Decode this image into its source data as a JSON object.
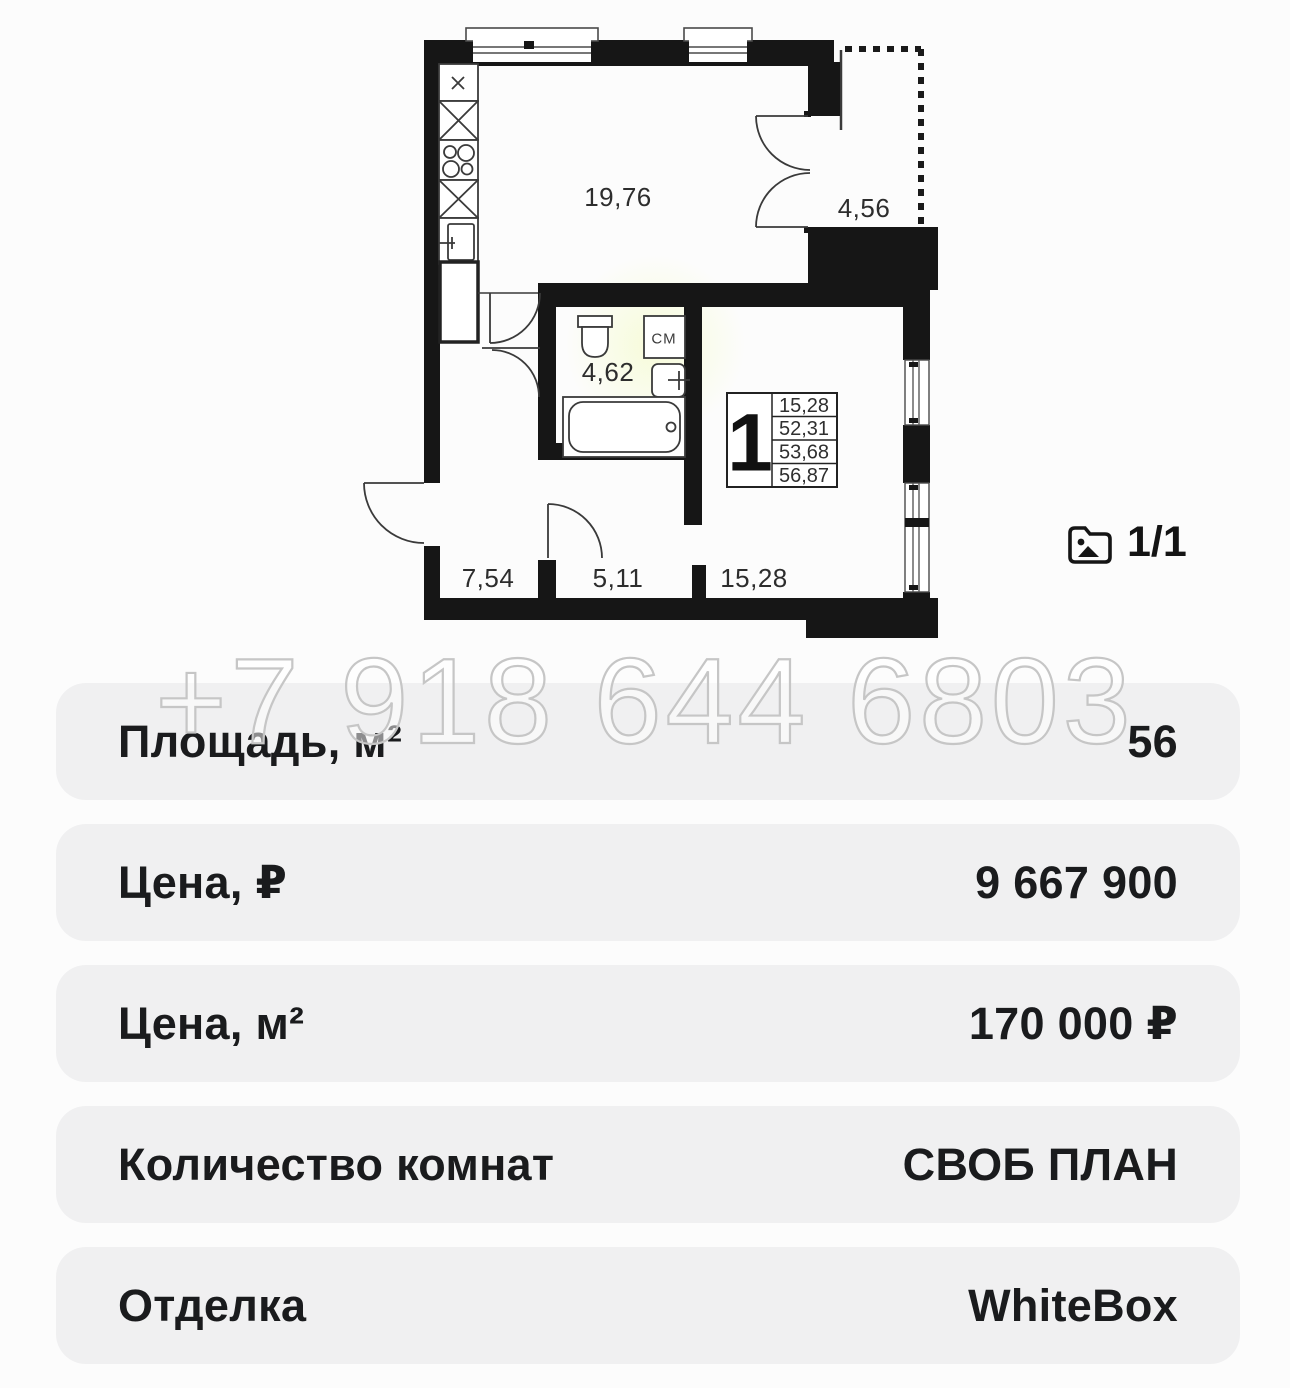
{
  "floor_plan": {
    "room_labels": {
      "kitchen_living": "19,76",
      "balcony": "4,56",
      "bathroom": "4,62",
      "hallway": "7,54",
      "corridor": "5,11",
      "room": "15,28"
    },
    "legend": {
      "rooms_count": "1",
      "areas": [
        "15,28",
        "52,31",
        "53,68",
        "56,87"
      ]
    },
    "washing_machine_label": "СМ"
  },
  "photo_counter": {
    "text": "1/1"
  },
  "watermark": {
    "text": "+7 918 644 6803"
  },
  "details": {
    "rows": [
      {
        "label": "Площадь, м²",
        "value": "56"
      },
      {
        "label": "Цена, ₽",
        "value": "9 667 900"
      },
      {
        "label": "Цена, м²",
        "value": "170 000 ₽"
      },
      {
        "label": "Количество комнат",
        "value": "СВОБ ПЛАН"
      },
      {
        "label": "Отделка",
        "value": "WhiteBox"
      }
    ]
  },
  "colors": {
    "wall": "#161616",
    "row_bg": "#f0f0f1",
    "text": "#1a1b1d",
    "watermark_stroke": "#c6c6c6"
  }
}
